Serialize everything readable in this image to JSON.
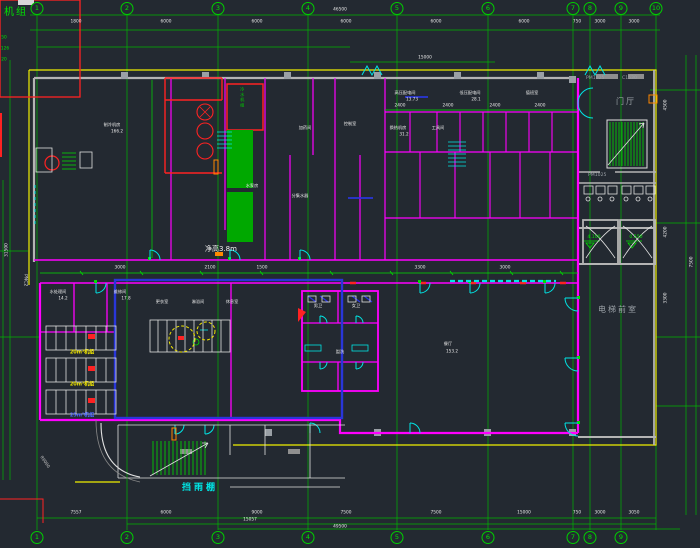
{
  "palette": {
    "background": "#232931",
    "grid_green": "#00cc00",
    "wall_magenta": "#ff00ff",
    "door_cyan": "#00ffff",
    "equip_red": "#ff2222",
    "boundary_yellow": "#ffff00",
    "wall_gray": "#b4b4b4",
    "annex_blue": "#2936d9",
    "accent_orange": "#ff8800",
    "text_white": "#e6e6e6"
  },
  "titleBox": {
    "label": "机组"
  },
  "gridBubbles": {
    "top": [
      {
        "t": "1",
        "x": 37,
        "y": 2
      },
      {
        "t": "2",
        "x": 127,
        "y": 2
      },
      {
        "t": "3",
        "x": 218,
        "y": 2
      },
      {
        "t": "4",
        "x": 308,
        "y": 2
      },
      {
        "t": "5",
        "x": 397,
        "y": 2
      },
      {
        "t": "6",
        "x": 488,
        "y": 2
      },
      {
        "t": "7",
        "x": 573,
        "y": 2
      },
      {
        "t": "8",
        "x": 590,
        "y": 2
      },
      {
        "t": "9",
        "x": 621,
        "y": 2
      },
      {
        "t": "10",
        "x": 656,
        "y": 2
      }
    ],
    "bottom": [
      {
        "t": "1",
        "x": 37,
        "y": 531
      },
      {
        "t": "2",
        "x": 127,
        "y": 531
      },
      {
        "t": "3",
        "x": 218,
        "y": 531
      },
      {
        "t": "4",
        "x": 308,
        "y": 531
      },
      {
        "t": "5",
        "x": 397,
        "y": 531
      },
      {
        "t": "6",
        "x": 488,
        "y": 531
      },
      {
        "t": "7",
        "x": 573,
        "y": 531
      },
      {
        "t": "8",
        "x": 590,
        "y": 531
      },
      {
        "t": "9",
        "x": 621,
        "y": 531
      }
    ]
  },
  "dims": {
    "topRow": [
      {
        "t": "1800",
        "x": 76,
        "y": 22
      },
      {
        "t": "6000",
        "x": 166,
        "y": 22
      },
      {
        "t": "6000",
        "x": 257,
        "y": 22
      },
      {
        "t": "6000",
        "x": 346,
        "y": 22
      },
      {
        "t": "6000",
        "x": 436,
        "y": 22
      },
      {
        "t": "6000",
        "x": 524,
        "y": 22
      },
      {
        "t": "750",
        "x": 577,
        "y": 22
      },
      {
        "t": "3000",
        "x": 600,
        "y": 22
      },
      {
        "t": "3000",
        "x": 634,
        "y": 22
      }
    ],
    "topTotal": [
      {
        "t": "46500",
        "x": 340,
        "y": 10
      },
      {
        "t": "15000",
        "x": 425,
        "y": 58
      }
    ],
    "bottomRow": [
      {
        "t": "7557",
        "x": 76,
        "y": 513
      },
      {
        "t": "6000",
        "x": 166,
        "y": 513
      },
      {
        "t": "9000",
        "x": 257,
        "y": 513
      },
      {
        "t": "7500",
        "x": 346,
        "y": 513
      },
      {
        "t": "7500",
        "x": 436,
        "y": 513
      },
      {
        "t": "15000",
        "x": 524,
        "y": 513
      },
      {
        "t": "750",
        "x": 577,
        "y": 513
      },
      {
        "t": "3000",
        "x": 600,
        "y": 513
      },
      {
        "t": "3050",
        "x": 634,
        "y": 513
      }
    ],
    "bottomExtras": [
      {
        "t": "15057",
        "x": 250,
        "y": 520
      },
      {
        "t": "49500",
        "x": 340,
        "y": 527
      }
    ],
    "corridor": [
      {
        "t": "3000",
        "x": 120,
        "y": 268
      },
      {
        "t": "2100",
        "x": 210,
        "y": 268
      },
      {
        "t": "1500",
        "x": 262,
        "y": 268
      },
      {
        "t": "3300",
        "x": 420,
        "y": 268
      },
      {
        "t": "3000",
        "x": 505,
        "y": 268
      }
    ],
    "innerTop": [
      {
        "t": "2400",
        "x": 400,
        "y": 106
      },
      {
        "t": "2400",
        "x": 448,
        "y": 106
      },
      {
        "t": "2400",
        "x": 495,
        "y": 106
      },
      {
        "t": "2400",
        "x": 540,
        "y": 106
      }
    ],
    "rightCol": [
      {
        "t": "4500",
        "x": 666,
        "y": 105
      },
      {
        "t": "4200",
        "x": 666,
        "y": 232
      },
      {
        "t": "3300",
        "x": 666,
        "y": 298
      },
      {
        "t": "7500",
        "x": 692,
        "y": 262
      }
    ],
    "leftCol": [
      {
        "t": "31500",
        "x": 7,
        "y": 250
      }
    ],
    "leftEdge": [
      {
        "t": "50",
        "x": 4,
        "y": 38
      },
      {
        "t": "126",
        "x": 5,
        "y": 49
      },
      {
        "t": "20",
        "x": 4,
        "y": 60
      }
    ]
  },
  "labels": {
    "clearHeight": "净高3.8m",
    "doorCode": "PM1025",
    "doorCode2": "PM1025",
    "windowCode": "C1530",
    "hall": "门厅",
    "lobby": "电梯前室",
    "canopy": "挡雨棚",
    "pipeCode": "PNC2",
    "radius": "R6000",
    "equipVert": "冷水机组"
  },
  "levelMarks": [
    {
      "t": "4.100",
      "x": 594,
      "y": 240
    },
    {
      "t": "0.550",
      "x": 636,
      "y": 240
    }
  ],
  "tankLabels": [
    {
      "t": "20m³机组",
      "x": 82,
      "y": 352,
      "color": "#f2e700"
    },
    {
      "t": "20m³机组",
      "x": 82,
      "y": 384,
      "color": "#f2e700"
    },
    {
      "t": "25m³机组",
      "x": 82,
      "y": 415,
      "color": "#4d66ff"
    }
  ],
  "roomLabels": [
    {
      "t": "制冷机房",
      "x": 112,
      "y": 125
    },
    {
      "t": "166.2",
      "x": 117,
      "y": 131
    },
    {
      "t": "水泵房",
      "x": 252,
      "y": 186
    },
    {
      "t": "分集水器",
      "x": 300,
      "y": 196
    },
    {
      "t": "加药间",
      "x": 305,
      "y": 128
    },
    {
      "t": "高压配电间",
      "x": 405,
      "y": 93
    },
    {
      "t": "13.73",
      "x": 412,
      "y": 99
    },
    {
      "t": "低压配电间",
      "x": 470,
      "y": 93
    },
    {
      "t": "28.1",
      "x": 476,
      "y": 99
    },
    {
      "t": "值班室",
      "x": 532,
      "y": 93
    },
    {
      "t": "控制室",
      "x": 350,
      "y": 124
    },
    {
      "t": "换热机房",
      "x": 398,
      "y": 128
    },
    {
      "t": "31.2",
      "x": 404,
      "y": 134
    },
    {
      "t": "工具间",
      "x": 438,
      "y": 128
    },
    {
      "t": "水处理间",
      "x": 58,
      "y": 292
    },
    {
      "t": "14.2",
      "x": 63,
      "y": 298
    },
    {
      "t": "维修间",
      "x": 120,
      "y": 292
    },
    {
      "t": "17.8",
      "x": 126,
      "y": 298
    },
    {
      "t": "更衣室",
      "x": 162,
      "y": 302
    },
    {
      "t": "淋浴间",
      "x": 198,
      "y": 302
    },
    {
      "t": "休息室",
      "x": 232,
      "y": 302
    },
    {
      "t": "男卫",
      "x": 318,
      "y": 306
    },
    {
      "t": "女卫",
      "x": 356,
      "y": 306
    },
    {
      "t": "盥洗",
      "x": 340,
      "y": 352
    },
    {
      "t": "餐厅",
      "x": 448,
      "y": 344
    },
    {
      "t": "153.2",
      "x": 452,
      "y": 351
    }
  ]
}
